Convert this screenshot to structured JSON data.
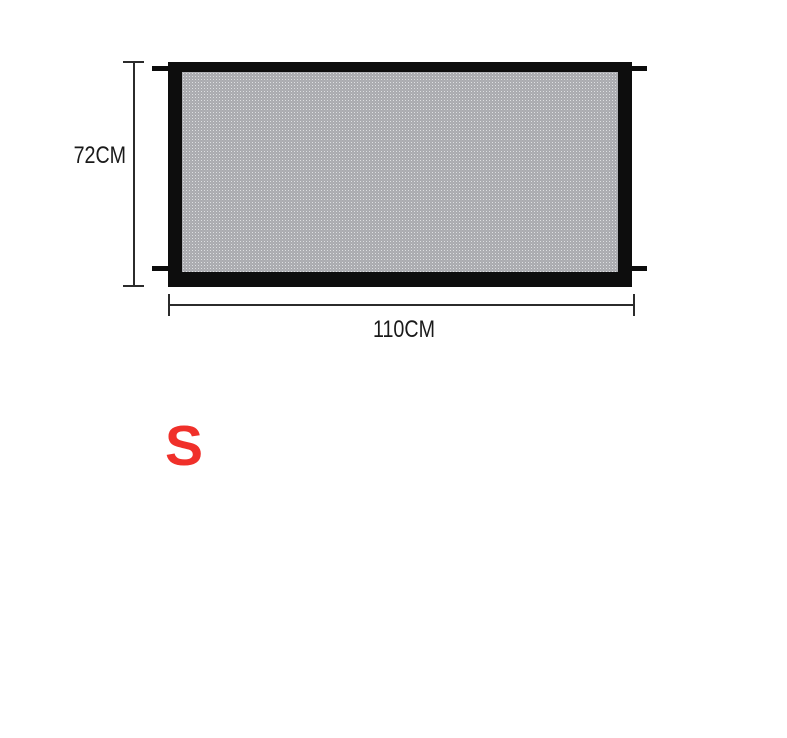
{
  "diagram": {
    "height_label": "72CM",
    "width_label": "110CM",
    "size_label": "S",
    "colors": {
      "frame_black": "#0d0d0d",
      "mesh_gray": "#8f9095",
      "dimension_line": "#2b2b2b",
      "size_red": "#f0302a",
      "background": "#ffffff"
    }
  }
}
